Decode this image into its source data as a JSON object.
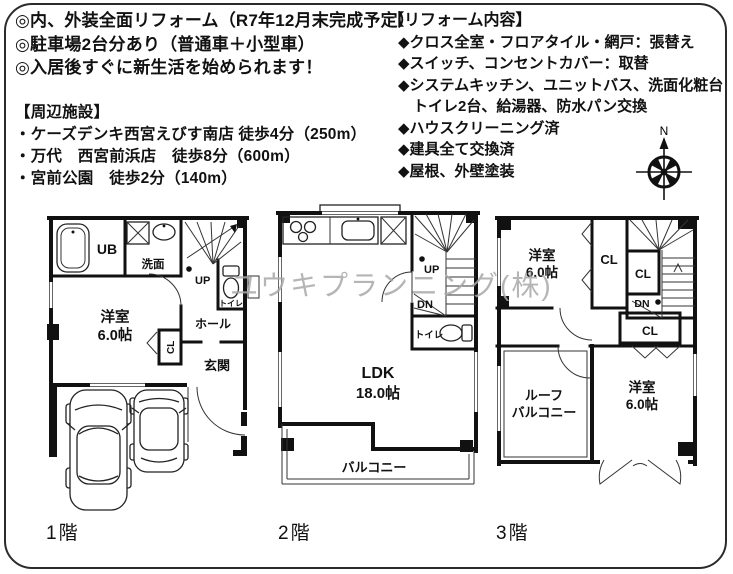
{
  "page": {
    "background": "#ffffff",
    "border_color": "#2b2b2b"
  },
  "highlights": {
    "items": [
      "◎内、外装全面リフォーム（R7年12月末完成予定）",
      "◎駐車場2台分あり（普通車＋小型車）",
      "◎入居後すぐに新生活を始められます！"
    ]
  },
  "reform": {
    "title": "【リフォーム内容】",
    "items": [
      "◆クロス全室・フロアタイル・網戸：張替え",
      "◆スイッチ、コンセントカバー：取替",
      "◆システムキッチン、ユニットバス、洗面化粧台",
      "　トイレ2台、給湯器、防水パン交換",
      "◆ハウスクリーニング済",
      "◆建具全て交換済",
      "◆屋根、外壁塗装"
    ]
  },
  "facilities": {
    "title": "【周辺施設】",
    "items": [
      "・ケーズデンキ西宮えびす南店 徒歩4分（250m）",
      "・万代　西宮前浜店　徒歩8分（600m）",
      "・宮前公園　徒歩2分（140m）"
    ]
  },
  "compass": {
    "north_label": "N"
  },
  "watermark": {
    "company": "ユウキプランニング(株)"
  },
  "floors": {
    "f1": {
      "label": "1階",
      "rooms": {
        "ub": "UB",
        "washroom": "洗面",
        "stairs_up": "UP",
        "toilet": "トイレ",
        "bedroom_name": "洋室",
        "bedroom_size": "6.0帖",
        "hall": "ホール",
        "closet": "CL",
        "entrance": "玄関"
      }
    },
    "f2": {
      "label": "2階",
      "rooms": {
        "stairs_up": "UP",
        "stairs_down": "DN",
        "toilet": "トイレ",
        "ldk_name": "LDK",
        "ldk_size": "18.0帖",
        "balcony": "バルコニー"
      }
    },
    "f3": {
      "label": "3階",
      "rooms": {
        "bedroom1_name": "洋室",
        "bedroom1_size": "6.0帖",
        "closet1": "CL",
        "closet2": "CL",
        "closet3": "CL",
        "stairs_down": "DN",
        "roof_balcony_line1": "ルーフ",
        "roof_balcony_line2": "バルコニー",
        "bedroom2_name": "洋室",
        "bedroom2_size": "6.0帖"
      }
    }
  }
}
